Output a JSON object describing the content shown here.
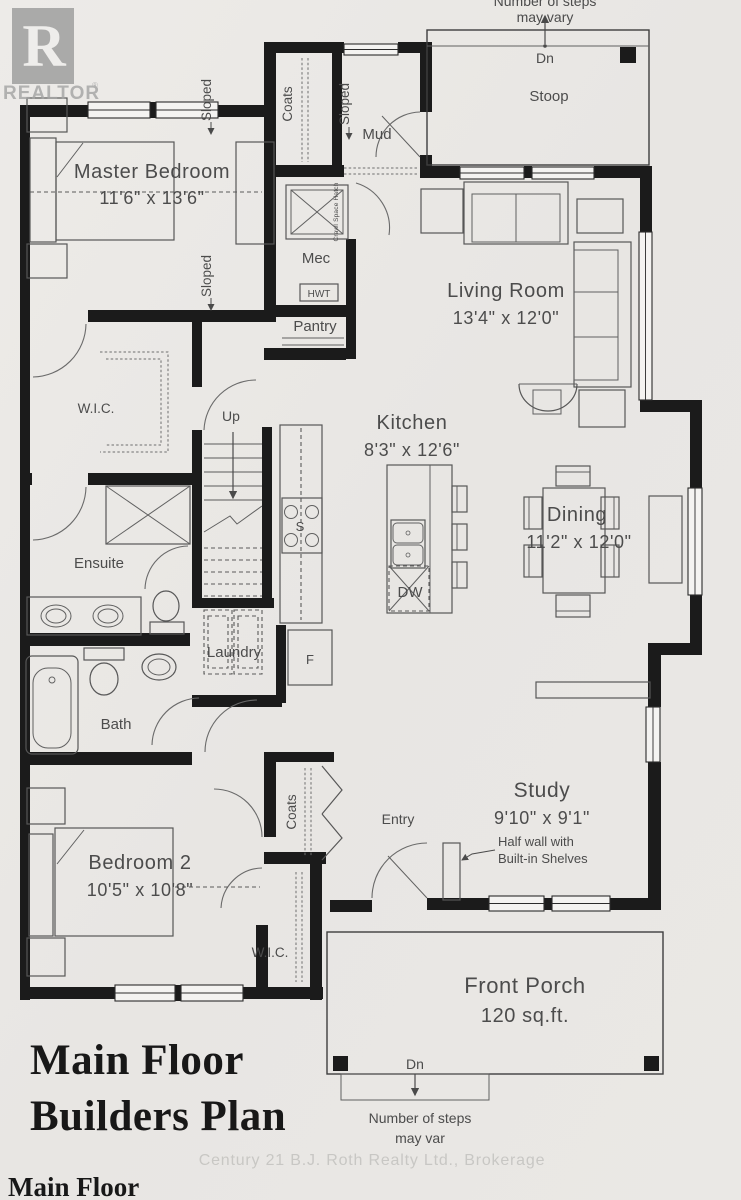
{
  "colors": {
    "paper": "#e9e7e4",
    "wall": "#1b1b1b",
    "line": "#575757",
    "label": "#4c4c4c",
    "watermark": "#c8c7c4",
    "logo_gray": "#9c9c9c"
  },
  "branding": {
    "logo_letter": "R",
    "logo_text": "REALTOR",
    "registered_mark": "®",
    "brokerage_watermark": "Century 21 B.J. Roth Realty Ltd., Brokerage"
  },
  "title_block": {
    "line1": "Main Floor",
    "line2": "Builders Plan",
    "footer": "Main Floor"
  },
  "rooms": {
    "master_bedroom": {
      "name": "Master Bedroom",
      "dims": "11'6\" x 13'6\""
    },
    "living_room": {
      "name": "Living Room",
      "dims": "13'4\" x 12'0\""
    },
    "kitchen": {
      "name": "Kitchen",
      "dims": "8'3\" x 12'6\""
    },
    "dining": {
      "name": "Dining",
      "dims": "11'2\" x 12'0\""
    },
    "study": {
      "name": "Study",
      "dims": "9'10\" x 9'1\""
    },
    "bedroom_2": {
      "name": "Bedroom 2",
      "dims": "10'5\" x 10'8\""
    },
    "front_porch": {
      "name": "Front Porch",
      "area": "120 sq.ft."
    },
    "stoop": {
      "name": "Stoop"
    },
    "mud": {
      "name": "Mud"
    },
    "mec": {
      "name": "Mec"
    },
    "pantry": {
      "name": "Pantry"
    },
    "laundry": {
      "name": "Laundry"
    },
    "ensuite": {
      "name": "Ensuite"
    },
    "bath": {
      "name": "Bath"
    },
    "entry": {
      "name": "Entry"
    },
    "master_wic": {
      "name": "W.I.C."
    },
    "bedroom2_wic": {
      "name": "W.I.C."
    },
    "coats_upper": {
      "name": "Coats"
    },
    "coats_lower": {
      "name": "Coats"
    }
  },
  "fixtures": {
    "stove": "S",
    "dishwasher": "DW",
    "fridge": "F",
    "hot_water_tank": "HWT",
    "crawl_space_hatch": "Crawl Space Hatch"
  },
  "stairs": {
    "up": "Up"
  },
  "notes": {
    "sloped": "Sloped",
    "stoop_down": "Dn",
    "porch_down": "Dn",
    "steps_note_line1": "Number of steps",
    "steps_note_line2": "may vary",
    "porch_steps_note_line1": "Number of steps",
    "porch_steps_note_line2": "may var",
    "half_wall_line1": "Half wall with",
    "half_wall_line2": "Built-in Shelves"
  }
}
